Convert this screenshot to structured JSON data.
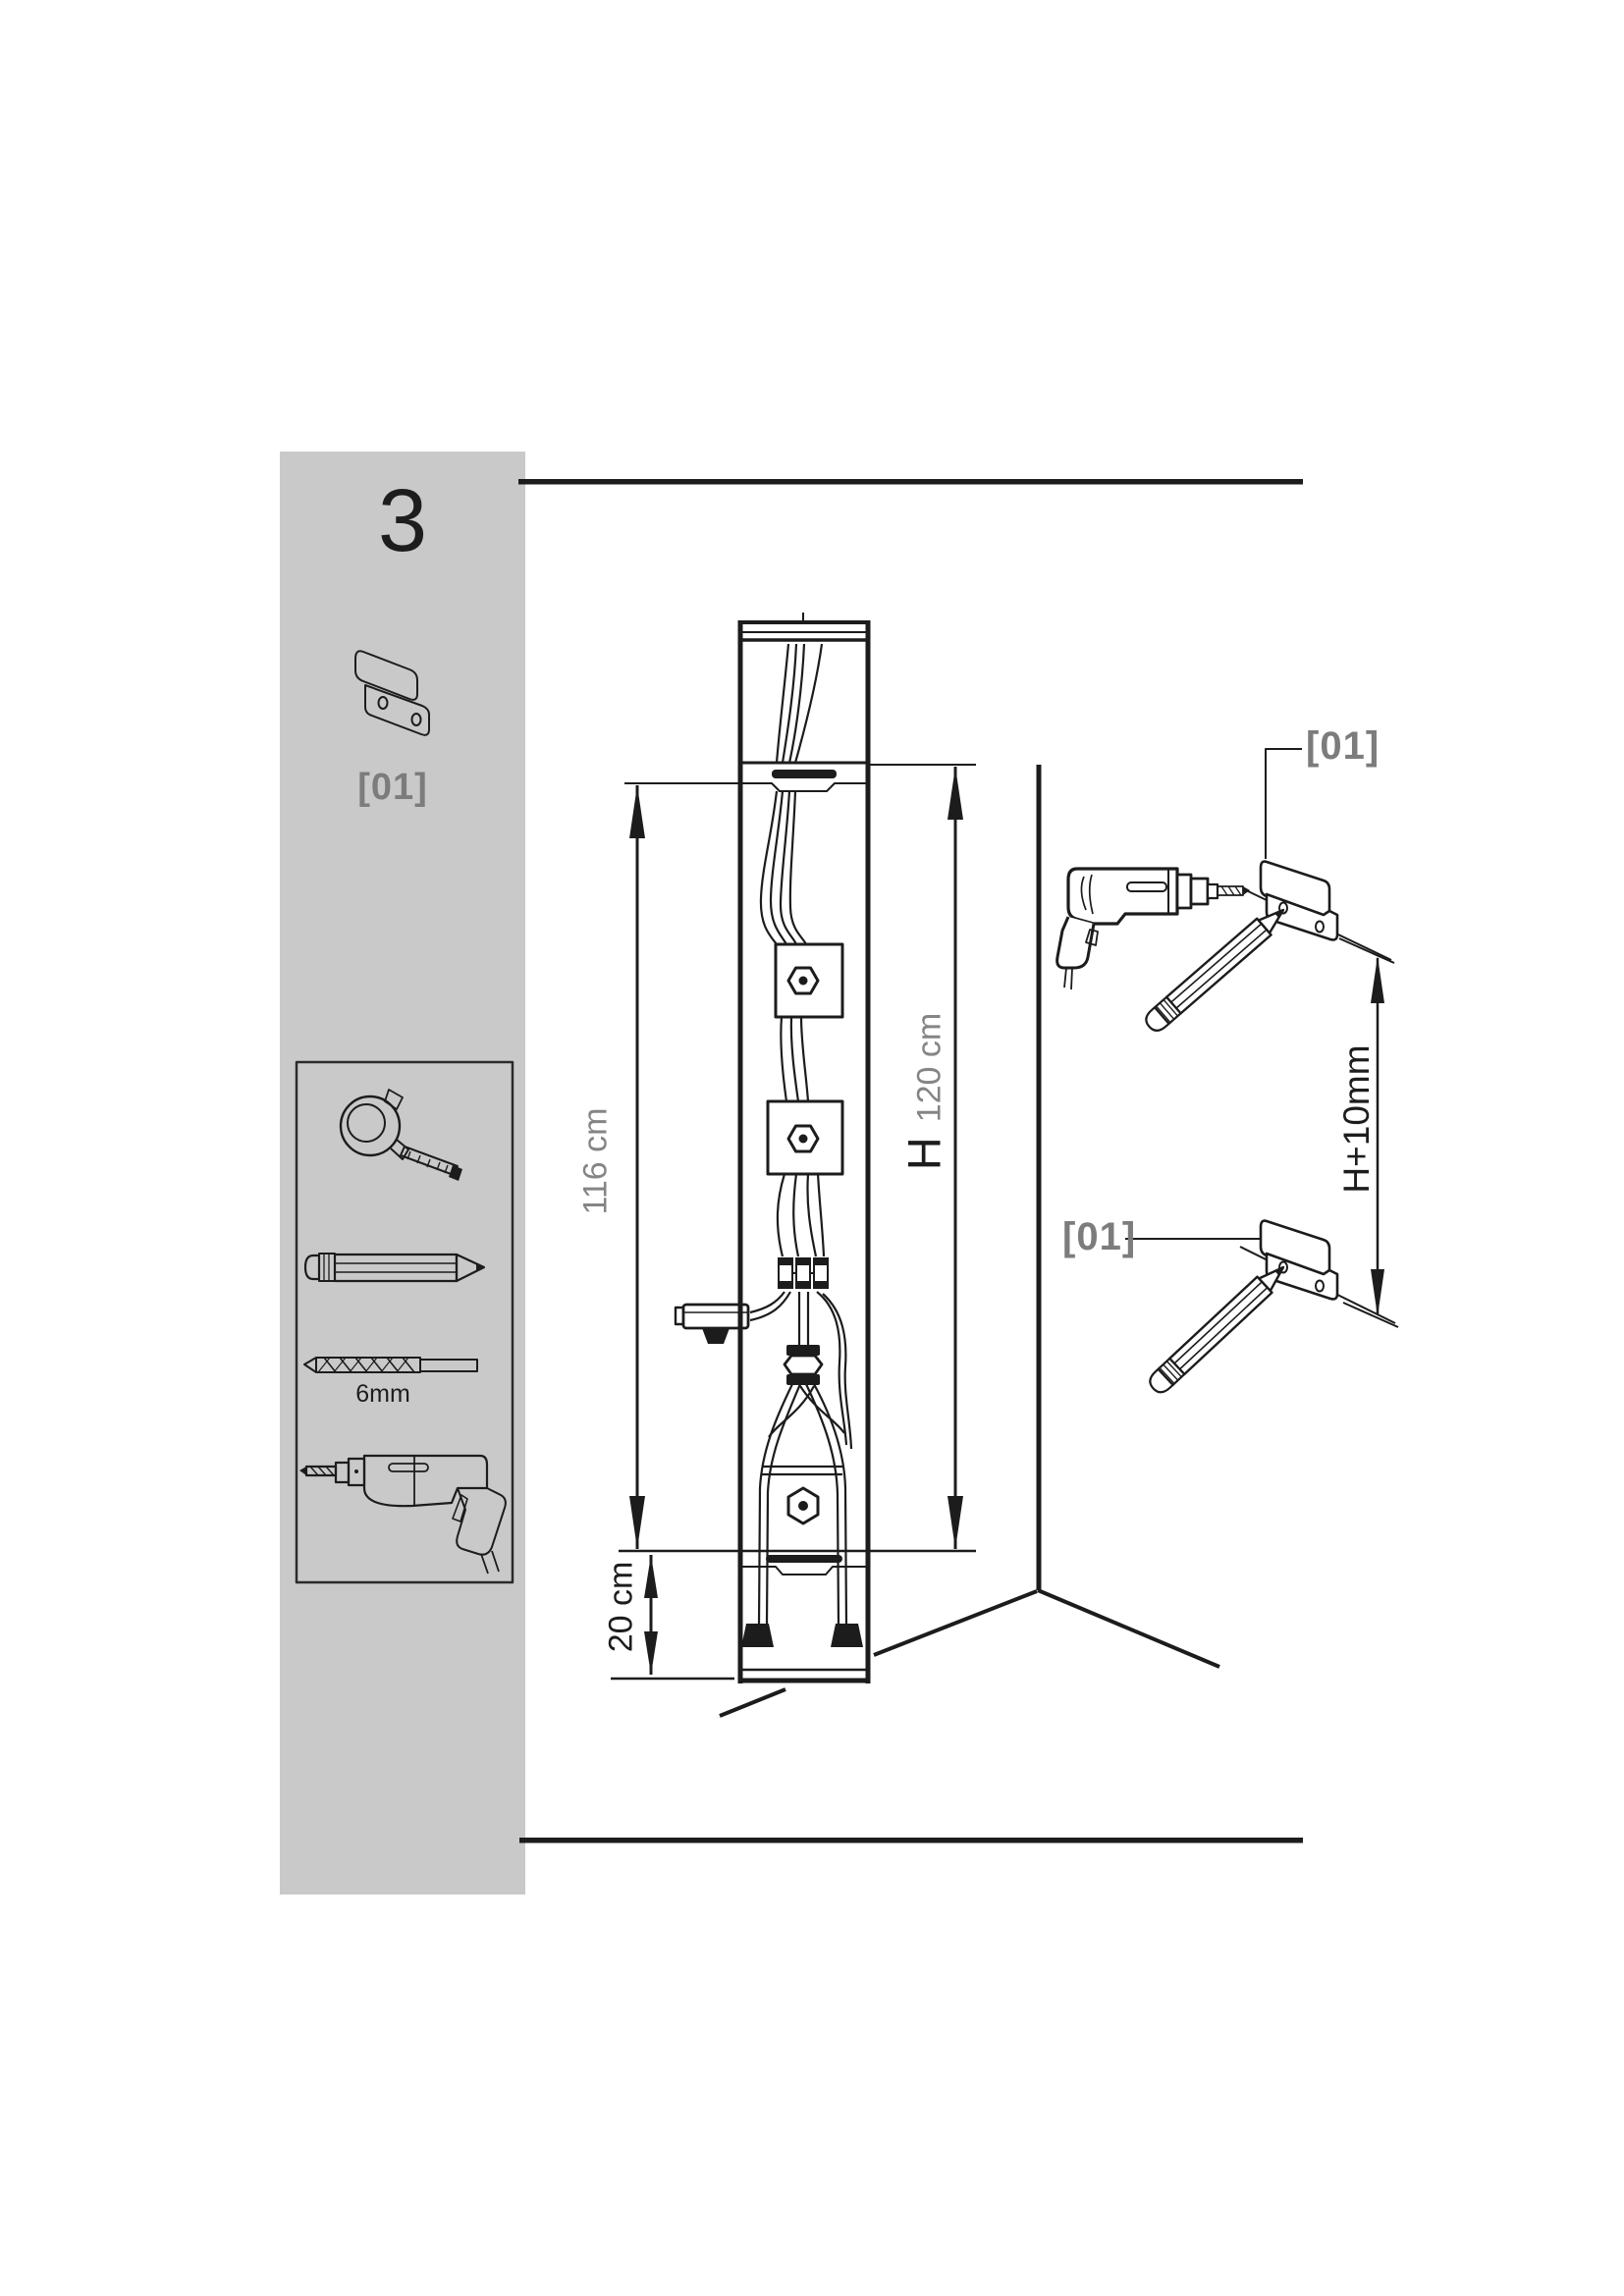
{
  "document": {
    "kind": "assembly-instruction-step",
    "background_color": "#ffffff",
    "sidebar_color": "#c9c9c9",
    "line_color": "#1c1c1c",
    "muted_text_color": "#858585",
    "label_gray_color": "#7c7c7c"
  },
  "sidebar": {
    "step_number": "3",
    "part": {
      "id_label": "[01]",
      "icon": "wall-bracket-icon"
    },
    "toolbox": {
      "tools": [
        {
          "icon": "tape-measure-icon"
        },
        {
          "icon": "pencil-icon"
        },
        {
          "icon": "drill-bit-icon",
          "label": "6mm"
        },
        {
          "icon": "power-drill-icon"
        }
      ]
    }
  },
  "main_diagram": {
    "dimensions": {
      "left": "116 cm",
      "right_primary": "H",
      "right_secondary": "120 cm",
      "bottom": "20 cm"
    }
  },
  "wall_detail": {
    "top_bracket_label": "[01]",
    "bottom_bracket_label": "[01]",
    "spacing_dimension": "H+10mm"
  }
}
